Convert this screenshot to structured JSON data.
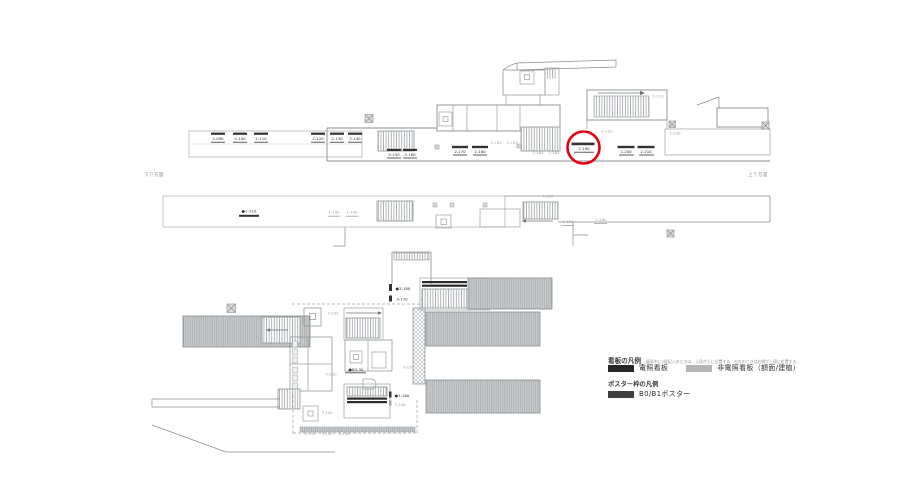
{
  "page": {
    "background": "#ffffff",
    "kind": "station-sign-location-drawing"
  },
  "palette": {
    "sign_black": "#333333",
    "sign_gray": "#a3a3a3",
    "line_light": "#b2b7ba",
    "line_mid": "#878d90",
    "hatch": "#9aa0a3",
    "band_fill": "#caccce",
    "red": "#e60012"
  },
  "highlight": {
    "target": "2-190",
    "color": "#e60012"
  },
  "annotations": {
    "left_note": "下り方面",
    "right_note": "上り方面"
  },
  "icons": {
    "crossed_box": "grid-marker-x-in-square",
    "elevator_box": "square-in-square-elevator",
    "stair_hatch": "fine-vertical-hatch",
    "platform_band": "gray-striped-band"
  },
  "legend": {
    "sign_title": "看板の凡例",
    "sign_note": "図面中に2段記入のときは、上段が上に位置する。左右のときは右側が上段に位置する。",
    "items": [
      {
        "label": "電照看板",
        "color": "#262626"
      },
      {
        "label": "非電照看板（額面/建植）",
        "color": "#b5b5b5"
      }
    ],
    "poster_title": "ポスター枠の凡例",
    "poster_items": [
      {
        "label": "B0/B1ポスター",
        "color": "#404040"
      }
    ]
  },
  "signs": [
    {
      "group": "L2",
      "label": "2-090",
      "x": 218,
      "y": 140,
      "color": "k",
      "bar": [
        211,
        132.6,
        14,
        2.2
      ],
      "underline": [
        211,
        141.8,
        14
      ]
    },
    {
      "group": "L2",
      "label": "2-100",
      "x": 240,
      "y": 140,
      "color": "k",
      "bar": [
        233,
        132.6,
        14,
        2.2
      ],
      "underline": [
        233,
        141.8,
        14
      ]
    },
    {
      "group": "L2",
      "label": "2-110",
      "x": 261,
      "y": 140,
      "color": "k",
      "bar": [
        254,
        132.6,
        14,
        2.2
      ],
      "underline": [
        254,
        141.8,
        14
      ]
    },
    {
      "group": "L2",
      "label": "2-120",
      "x": 318,
      "y": 140,
      "color": "k",
      "bar": [
        311,
        132.6,
        14,
        2.2
      ],
      "underline": [
        311,
        141.8,
        14
      ]
    },
    {
      "group": "L2",
      "label": "2-130",
      "x": 337,
      "y": 140,
      "color": "k",
      "bar": [
        330,
        132.6,
        14,
        2.2
      ],
      "underline": [
        330,
        141.8,
        14
      ]
    },
    {
      "group": "L2",
      "label": "2-140",
      "x": 355,
      "y": 140,
      "color": "k",
      "bar": [
        348,
        132.6,
        14,
        2.2
      ],
      "underline": [
        348,
        141.8,
        14
      ]
    },
    {
      "group": "L2",
      "label": "2-150",
      "x": 394,
      "y": 156,
      "color": "k",
      "bar": [
        387,
        148.8,
        14,
        2.2
      ],
      "underline": [
        387,
        157.6,
        14
      ]
    },
    {
      "group": "L2",
      "label": "2-160",
      "x": 410,
      "y": 156,
      "color": "k",
      "bar": [
        403,
        148.8,
        14,
        2.2
      ],
      "underline": [
        403,
        157.6,
        14
      ]
    },
    {
      "group": "L2",
      "label": "2-170",
      "x": 460,
      "y": 153,
      "color": "k",
      "bar": [
        452,
        145.8,
        16,
        2.4
      ],
      "underline": [
        453,
        154.6,
        14
      ]
    },
    {
      "group": "L2",
      "label": "2-180",
      "x": 480,
      "y": 153,
      "color": "k",
      "bar": [
        472,
        145.8,
        16,
        2.4
      ],
      "underline": [
        473,
        154.6,
        14
      ]
    },
    {
      "group": "L2",
      "label": "2-182",
      "x": 496,
      "y": 144,
      "color": "g"
    },
    {
      "group": "L2",
      "label": "2-183",
      "x": 512,
      "y": 144,
      "color": "g"
    },
    {
      "group": "L2",
      "label": "2-184",
      "x": 538,
      "y": 154,
      "color": "g"
    },
    {
      "group": "L2",
      "label": "2-185",
      "x": 554,
      "y": 154,
      "color": "g"
    },
    {
      "group": "L2",
      "label": "2-190",
      "x": 584,
      "y": 150,
      "color": "k",
      "bar": [
        571.5,
        142.6,
        23,
        2.6
      ],
      "underline": [
        574,
        151.8,
        20
      ]
    },
    {
      "group": "L2",
      "label": "2-200",
      "x": 626,
      "y": 153,
      "color": "k",
      "bar": [
        617.5,
        145.8,
        17,
        2.4
      ],
      "underline": [
        619,
        154.6,
        15
      ]
    },
    {
      "group": "L2",
      "label": "2-210",
      "x": 646,
      "y": 153,
      "color": "k",
      "bar": [
        637.5,
        145.8,
        17,
        2.4
      ],
      "underline": [
        639,
        154.6,
        15
      ]
    },
    {
      "group": "L2",
      "label": "2-220",
      "x": 607,
      "y": 132.5,
      "color": "g"
    },
    {
      "group": "L2",
      "label": "2-230",
      "x": 675,
      "y": 134.5,
      "color": "g"
    },
    {
      "group": "L2",
      "label": "3-110",
      "x": 658,
      "y": 97.5,
      "color": "g"
    },
    {
      "group": "L1",
      "label": "●1-110",
      "x": 249,
      "y": 212.5,
      "color": "k",
      "bar": [
        239,
        214.8,
        20,
        2
      ]
    },
    {
      "group": "L1",
      "label": "1-130",
      "x": 334,
      "y": 213.5,
      "color": "g",
      "underline": [
        327.5,
        215.8,
        13
      ]
    },
    {
      "group": "L1",
      "label": "1-140",
      "x": 352,
      "y": 213.5,
      "color": "g",
      "underline": [
        345.5,
        215.8,
        13
      ]
    },
    {
      "group": "L1",
      "label": "1-200",
      "x": 548,
      "y": 197.5,
      "color": "g"
    },
    {
      "group": "L1",
      "label": "1-150",
      "x": 568,
      "y": 223,
      "color": "g",
      "underline": [
        561,
        225.2,
        13
      ]
    },
    {
      "group": "L1",
      "label": "1-160",
      "x": 601,
      "y": 221,
      "color": "g",
      "underline": [
        594,
        223.2,
        13
      ]
    },
    {
      "group": "L3",
      "label": "3-100",
      "x": 333,
      "y": 314.5,
      "color": "g"
    },
    {
      "group": "L3",
      "label": "●3-180",
      "x": 403,
      "y": 290,
      "color": "k",
      "vbar": [
        389,
        284,
        3,
        7
      ]
    },
    {
      "group": "L3",
      "label": "3-170",
      "x": 402,
      "y": 300.5,
      "color": "k",
      "vbar": [
        389,
        295.5,
        3,
        6
      ]
    },
    {
      "group": "L3",
      "label": "3-200",
      "x": 331,
      "y": 375.5,
      "color": "g"
    },
    {
      "group": "L3",
      "label": "●B3-30",
      "x": 356,
      "y": 371,
      "color": "k",
      "underline": [
        345,
        372.4,
        21
      ]
    },
    {
      "group": "L3",
      "label": "3-210",
      "x": 408,
      "y": 368.5,
      "color": "g"
    },
    {
      "group": "L3",
      "label": "●3-160",
      "x": 402,
      "y": 397,
      "color": "k",
      "vbar": [
        389,
        391.5,
        2.5,
        6
      ]
    },
    {
      "group": "L3",
      "label": "3-150",
      "x": 400,
      "y": 406,
      "color": "g",
      "vbar": [
        389,
        400.5,
        2.5,
        5
      ]
    },
    {
      "group": "L3",
      "label": "3-140",
      "x": 327,
      "y": 414,
      "color": "g"
    },
    {
      "group": "L3",
      "label": "3-115",
      "x": 310,
      "y": 435,
      "color": "g"
    },
    {
      "group": "L3",
      "label": "3-120",
      "x": 327,
      "y": 435,
      "color": "g"
    },
    {
      "group": "L3",
      "label": "3-130",
      "x": 344,
      "y": 435,
      "color": "g"
    }
  ]
}
